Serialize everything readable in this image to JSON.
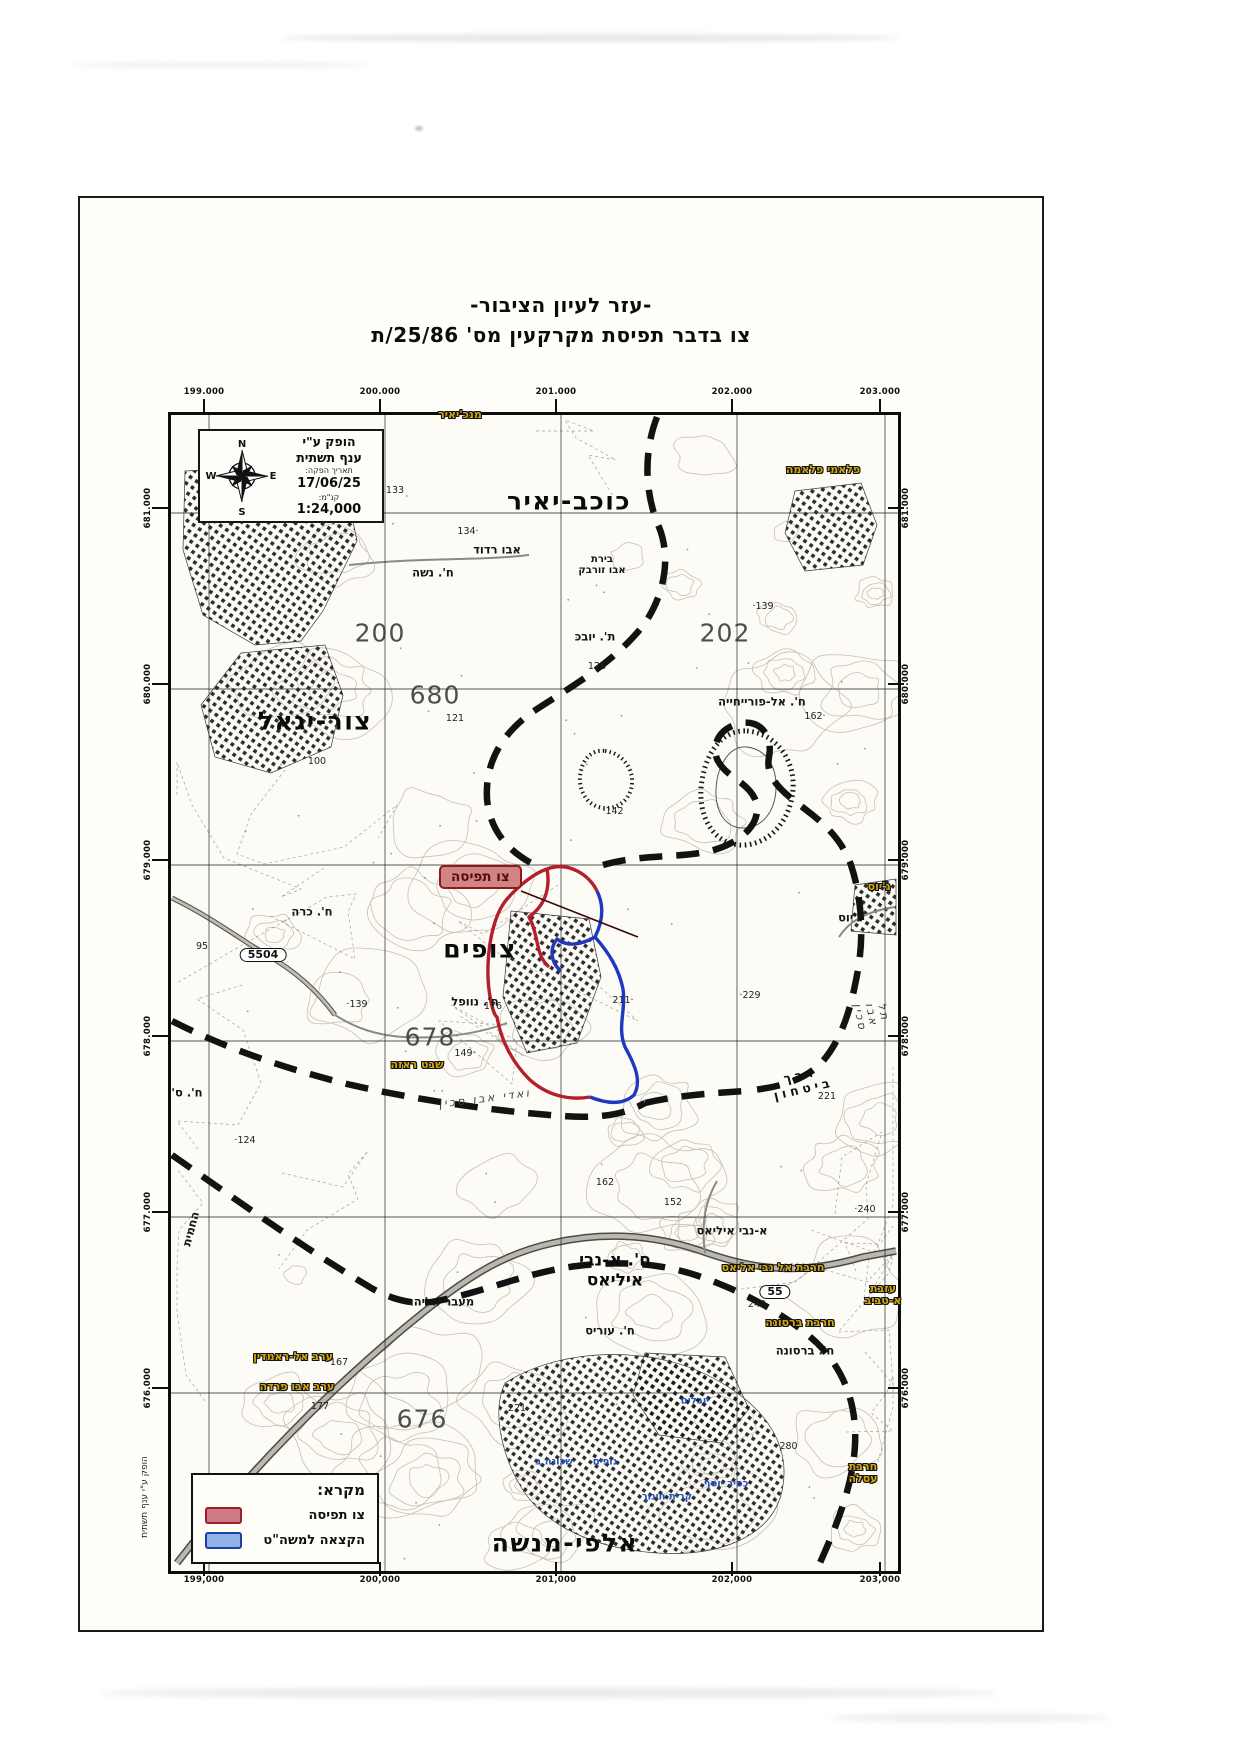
{
  "page": {
    "title_line1": "-עזר לעיון הציבור-",
    "title_line2": "צו בדבר תפיסת מקרקעין מס' 25/86/ת"
  },
  "info_box": {
    "produced_by_line1": "הופק ע\"י",
    "produced_by_line2": "ענף תשתית",
    "date_label": "תאריך הפקה:",
    "date_value": "17/06/25",
    "scale_label": "קנ\"מ:",
    "scale_value": "1:24,000",
    "compass": {
      "n": "N",
      "e": "E",
      "s": "S",
      "w": "W"
    }
  },
  "callout": {
    "label": "צו תפיסה"
  },
  "legend": {
    "title": "מקרא:",
    "items": [
      {
        "label": "צו תפיסה",
        "fill": "#cf7b85",
        "border": "#a01d30"
      },
      {
        "label": "הקצאה למשה\"ט",
        "fill": "#8fb3e6",
        "border": "#1f3fa8"
      }
    ]
  },
  "side_note": "הופק ע\"י ענף תשתית",
  "grid": {
    "top": [
      "199.000",
      "200.000",
      "201.000",
      "202.000",
      "203.000"
    ],
    "bottom": [
      "199,000",
      "200,000",
      "201,000",
      "202,000",
      "203,000"
    ],
    "left": [
      "681.000",
      "680.000",
      "679.000",
      "678.000",
      "677.000",
      "676.000"
    ],
    "right": [
      "681.000",
      "680.000",
      "679.000",
      "678.000",
      "677.000",
      "676.000"
    ]
  },
  "map": {
    "labels": [
      {
        "t": "כוכב-יאיר",
        "x": 564,
        "y": 496,
        "c": "city"
      },
      {
        "t": "צור-יגאל",
        "x": 310,
        "y": 716,
        "c": "city"
      },
      {
        "t": "צופים",
        "x": 475,
        "y": 944,
        "c": "city"
      },
      {
        "t": "ח'. א-נבי\nאיליאס",
        "x": 610,
        "y": 1266,
        "c": "city2"
      },
      {
        "t": "אלפי-מנשה",
        "x": 560,
        "y": 1538,
        "c": "city"
      },
      {
        "t": "200",
        "x": 375,
        "y": 628,
        "c": "gridnum"
      },
      {
        "t": "202",
        "x": 720,
        "y": 628,
        "c": "gridnum"
      },
      {
        "t": "680",
        "x": 430,
        "y": 690,
        "c": "gridnum"
      },
      {
        "t": "678",
        "x": 425,
        "y": 1032,
        "c": "gridnum"
      },
      {
        "t": "676",
        "x": 417,
        "y": 1414,
        "c": "gridnum"
      },
      {
        "t": "אבו רדוד",
        "x": 492,
        "y": 545,
        "c": "place"
      },
      {
        "t": "ח'. נשה",
        "x": 428,
        "y": 568,
        "c": "place"
      },
      {
        "t": "בירת\nאבו זורבק",
        "x": 597,
        "y": 560,
        "c": "place2"
      },
      {
        "t": "ת'. יובכ",
        "x": 590,
        "y": 632,
        "c": "place"
      },
      {
        "t": "ח'. אל-פורייחייה",
        "x": 757,
        "y": 697,
        "c": "place"
      },
      {
        "t": "ח'. כרה",
        "x": 307,
        "y": 907,
        "c": "place"
      },
      {
        "t": "ח'. נוופל",
        "x": 470,
        "y": 997,
        "c": "place"
      },
      {
        "t": "ג'יוס",
        "x": 845,
        "y": 913,
        "c": "place"
      },
      {
        "t": "א-נבי איליאס",
        "x": 727,
        "y": 1226,
        "c": "place"
      },
      {
        "t": "ח'. עוריס",
        "x": 605,
        "y": 1326,
        "c": "place"
      },
      {
        "t": "ח'. ברסונה",
        "x": 800,
        "y": 1346,
        "c": "place"
      },
      {
        "t": "מעבר אליהו",
        "x": 437,
        "y": 1297,
        "c": "place"
      },
      {
        "t": "ח'. ס'",
        "x": 182,
        "y": 1088,
        "c": "place"
      },
      {
        "t": "החמית",
        "x": 186,
        "y": 1224,
        "c": "place",
        "r": -75
      },
      {
        "t": "133",
        "x": 390,
        "y": 486,
        "c": "spot"
      },
      {
        "t": "·134",
        "x": 463,
        "y": 527,
        "c": "spot"
      },
      {
        "t": "126",
        "x": 592,
        "y": 662,
        "c": "spot"
      },
      {
        "t": "121",
        "x": 450,
        "y": 714,
        "c": "spot"
      },
      {
        "t": "100",
        "x": 312,
        "y": 757,
        "c": "spot"
      },
      {
        "t": "139·",
        "x": 758,
        "y": 602,
        "c": "spot"
      },
      {
        "t": "142·",
        "x": 608,
        "y": 807,
        "c": "spot"
      },
      {
        "t": "·162",
        "x": 810,
        "y": 712,
        "c": "spot"
      },
      {
        "t": "95",
        "x": 197,
        "y": 942,
        "c": "spot"
      },
      {
        "t": "139·",
        "x": 352,
        "y": 1000,
        "c": "spot"
      },
      {
        "t": "176",
        "x": 488,
        "y": 1002,
        "c": "spot"
      },
      {
        "t": "·211",
        "x": 618,
        "y": 996,
        "c": "spot"
      },
      {
        "t": "229·",
        "x": 745,
        "y": 991,
        "c": "spot"
      },
      {
        "t": "·149",
        "x": 460,
        "y": 1049,
        "c": "spot"
      },
      {
        "t": "124·",
        "x": 240,
        "y": 1136,
        "c": "spot"
      },
      {
        "t": "162",
        "x": 600,
        "y": 1178,
        "c": "spot"
      },
      {
        "t": "152",
        "x": 668,
        "y": 1198,
        "c": "spot"
      },
      {
        "t": "240·",
        "x": 860,
        "y": 1205,
        "c": "spot"
      },
      {
        "t": "221",
        "x": 822,
        "y": 1092,
        "c": "spot"
      },
      {
        "t": "167",
        "x": 334,
        "y": 1358,
        "c": "spot"
      },
      {
        "t": "177",
        "x": 315,
        "y": 1402,
        "c": "spot"
      },
      {
        "t": "221",
        "x": 512,
        "y": 1404,
        "c": "spot"
      },
      {
        "t": "280·",
        "x": 782,
        "y": 1442,
        "c": "spot"
      },
      {
        "t": "240",
        "x": 752,
        "y": 1300,
        "c": "spot"
      },
      {
        "t": "מנכ'יאיר",
        "x": 455,
        "y": 410,
        "c": "olive"
      },
      {
        "t": "פלאמי פלאמה",
        "x": 818,
        "y": 465,
        "c": "olive"
      },
      {
        "t": "ג'יוס",
        "x": 874,
        "y": 882,
        "c": "olive"
      },
      {
        "t": "שבט ראזה",
        "x": 412,
        "y": 1060,
        "c": "olive"
      },
      {
        "t": "חרבת אל נבי אליאס",
        "x": 768,
        "y": 1263,
        "c": "olive"
      },
      {
        "t": "חרבת ברסונה",
        "x": 795,
        "y": 1318,
        "c": "olive"
      },
      {
        "t": "עזבת א-טביב",
        "x": 878,
        "y": 1290,
        "c": "olive"
      },
      {
        "t": "ערב אל-ראמדין",
        "x": 288,
        "y": 1352,
        "c": "olive"
      },
      {
        "t": "ערב אבו פרדה",
        "x": 292,
        "y": 1382,
        "c": "olive"
      },
      {
        "t": "חרבת עסלה",
        "x": 858,
        "y": 1468,
        "c": "olive"
      },
      {
        "t": "יובלים",
        "x": 690,
        "y": 1396,
        "c": "blue"
      },
      {
        "t": "נופים",
        "x": 600,
        "y": 1457,
        "c": "blue"
      },
      {
        "t": "שכונה ב",
        "x": 549,
        "y": 1457,
        "c": "blue"
      },
      {
        "t": "כפיר יוסף",
        "x": 721,
        "y": 1479,
        "c": "blue"
      },
      {
        "t": "קרית חינוך",
        "x": 662,
        "y": 1492,
        "c": "blue"
      },
      {
        "t": "דרך ביטחון",
        "x": 797,
        "y": 1077,
        "c": "secroad",
        "r": -13
      },
      {
        "t": "ואדי אבו סכין",
        "x": 480,
        "y": 1094,
        "c": "stream",
        "r": -7
      },
      {
        "t": "תל אבו סכין",
        "x": 866,
        "y": 1010,
        "c": "stream",
        "r": 78
      },
      {
        "t": "5504",
        "x": 258,
        "y": 950,
        "c": "badge"
      },
      {
        "t": "55",
        "x": 770,
        "y": 1287,
        "c": "badge"
      }
    ]
  }
}
